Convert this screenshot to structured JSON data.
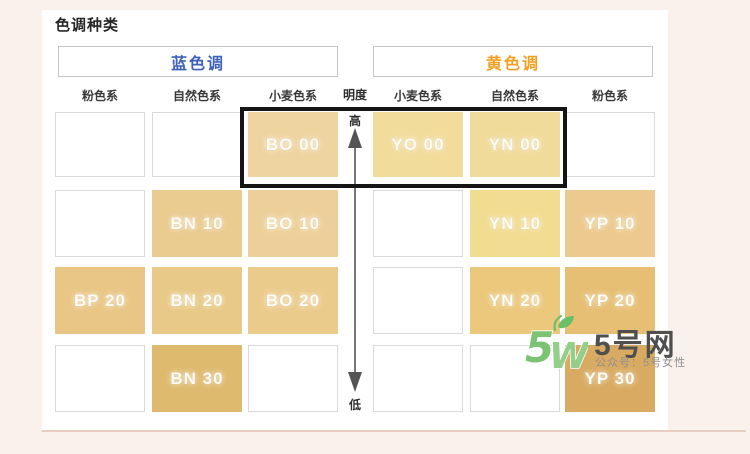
{
  "page": {
    "title": "色调种类"
  },
  "tone_groups": {
    "blue": {
      "label": "蓝色调",
      "color": "#3f62b8"
    },
    "yellow": {
      "label": "黄色调",
      "color": "#f0a125"
    }
  },
  "column_headers": [
    "粉色系",
    "自然色系",
    "小麦色系",
    "小麦色系",
    "自然色系",
    "粉色系"
  ],
  "brightness_axis": {
    "label": "明度",
    "high": "高",
    "low": "低"
  },
  "shade_grid": {
    "rows": [
      "00",
      "10",
      "20",
      "30"
    ],
    "cells": [
      {
        "row": 0,
        "col": 0,
        "label": "",
        "color": null
      },
      {
        "row": 0,
        "col": 1,
        "label": "",
        "color": null
      },
      {
        "row": 0,
        "col": 2,
        "label": "BO 00",
        "color": "#eed4a1"
      },
      {
        "row": 0,
        "col": 3,
        "label": "YO 00",
        "color": "#f1dc9c"
      },
      {
        "row": 0,
        "col": 4,
        "label": "YN 00",
        "color": "#f0db9a"
      },
      {
        "row": 0,
        "col": 5,
        "label": "",
        "color": null
      },
      {
        "row": 1,
        "col": 0,
        "label": "",
        "color": null
      },
      {
        "row": 1,
        "col": 1,
        "label": "BN 10",
        "color": "#eacb90"
      },
      {
        "row": 1,
        "col": 2,
        "label": "BO 10",
        "color": "#edd099"
      },
      {
        "row": 1,
        "col": 3,
        "label": "",
        "color": null
      },
      {
        "row": 1,
        "col": 4,
        "label": "YN 10",
        "color": "#f2dc92"
      },
      {
        "row": 1,
        "col": 5,
        "label": "YP 10",
        "color": "#ecca8f"
      },
      {
        "row": 2,
        "col": 0,
        "label": "BP 20",
        "color": "#e9c686"
      },
      {
        "row": 2,
        "col": 1,
        "label": "BN 20",
        "color": "#e9c987"
      },
      {
        "row": 2,
        "col": 2,
        "label": "BO 20",
        "color": "#ebcb8c"
      },
      {
        "row": 2,
        "col": 3,
        "label": "",
        "color": null
      },
      {
        "row": 2,
        "col": 4,
        "label": "YN 20",
        "color": "#ecc87d"
      },
      {
        "row": 2,
        "col": 5,
        "label": "YP 20",
        "color": "#e6bf74"
      },
      {
        "row": 3,
        "col": 0,
        "label": "",
        "color": null
      },
      {
        "row": 3,
        "col": 1,
        "label": "BN 30",
        "color": "#deba6e"
      },
      {
        "row": 3,
        "col": 2,
        "label": "",
        "color": null
      },
      {
        "row": 3,
        "col": 3,
        "label": "",
        "color": null
      },
      {
        "row": 3,
        "col": 4,
        "label": "",
        "color": null
      },
      {
        "row": 3,
        "col": 5,
        "label": "YP 30",
        "color": "#d9ab62"
      }
    ]
  },
  "watermark": {
    "logo_text": "5W",
    "site_name": "5号网",
    "subtitle": "公众号：5号女性"
  }
}
